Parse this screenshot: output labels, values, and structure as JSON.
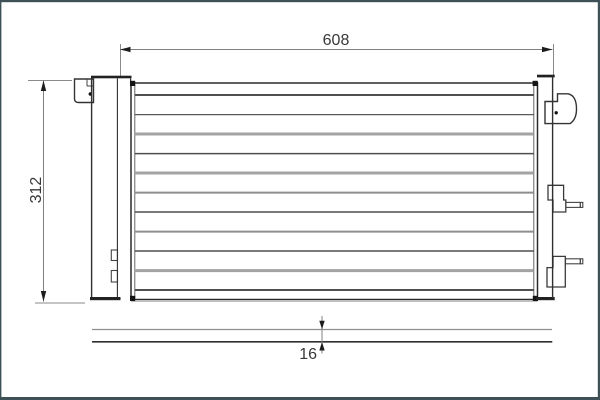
{
  "drawing": {
    "kind": "technical-dimensional-drawing",
    "views": [
      "front-view",
      "side-profile-view"
    ]
  },
  "dimensions": {
    "width": {
      "label": "608"
    },
    "height": {
      "label": "312"
    },
    "depth": {
      "label": "16"
    }
  },
  "colors": {
    "frame": "#3d5156",
    "background": "#ffffff",
    "line_dark": "#2f2f2f",
    "line_gray": "#a3a3a3",
    "dim_line": "#808080",
    "arrow": "#1c1c1c",
    "text": "#383838"
  },
  "core_tubes": {
    "x1": 134.8,
    "x2": 533.8,
    "lines": [
      {
        "y": 95.0,
        "w": 1.9,
        "c": "#4f4f4f"
      },
      {
        "y": 114.6,
        "w": 1.2,
        "c": "#5a5a5a"
      },
      {
        "y": 134.0,
        "w": 3.0,
        "c": "#a3a3a3"
      },
      {
        "y": 153.6,
        "w": 1.5,
        "c": "#4f4f4f"
      },
      {
        "y": 173.0,
        "w": 3.0,
        "c": "#a3a3a3"
      },
      {
        "y": 192.6,
        "w": 2.0,
        "c": "#8e8e8e"
      },
      {
        "y": 212.0,
        "w": 1.5,
        "c": "#4f4f4f"
      },
      {
        "y": 231.6,
        "w": 2.0,
        "c": "#8e8e8e"
      },
      {
        "y": 251.0,
        "w": 1.5,
        "c": "#4f4f4f"
      },
      {
        "y": 270.6,
        "w": 3.0,
        "c": "#a3a3a3"
      },
      {
        "y": 290.0,
        "w": 1.9,
        "c": "#4f4f4f"
      }
    ]
  }
}
